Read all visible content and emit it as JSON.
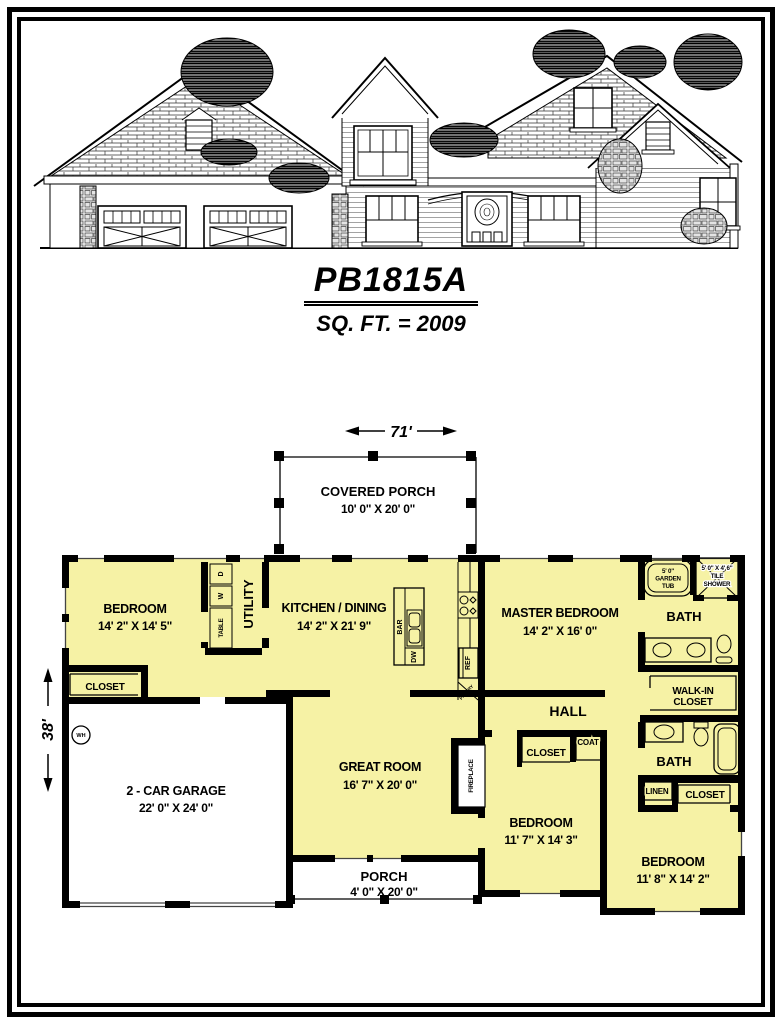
{
  "title": {
    "plan_number": "PB1815A",
    "sqft": "SQ. FT. = 2009"
  },
  "dimensions": {
    "overall_width": "71'",
    "overall_depth": "38'"
  },
  "colors": {
    "room_fill": "#F6F2A5",
    "wall": "#000000",
    "paper": "#FFFFFF"
  },
  "rooms": {
    "covered_porch": {
      "name": "COVERED PORCH",
      "dims": "10' 0\" X 20' 0\""
    },
    "bedroom1": {
      "name": "BEDROOM",
      "dims": "14' 2\" X 14' 5\""
    },
    "closet_bedroom1": {
      "name": "CLOSET"
    },
    "utility": {
      "name": "UTILITY"
    },
    "kitchen": {
      "name": "KITCHEN / DINING",
      "dims": "14' 2\" X 21' 9\""
    },
    "master_bedroom": {
      "name": "MASTER BEDROOM",
      "dims": "14' 2\" X 16' 0\""
    },
    "master_bath": {
      "name": "BATH"
    },
    "walk_in_closet": {
      "line1": "WALK-IN",
      "line2": "CLOSET"
    },
    "hall": {
      "name": "HALL"
    },
    "garage": {
      "name": "2 - CAR GARAGE",
      "dims": "22' 0\" X 24' 0\""
    },
    "great_room": {
      "name": "GREAT ROOM",
      "dims": "16' 7\" X 20' 0\""
    },
    "hall_closet": {
      "name": "CLOSET"
    },
    "coat_closet": {
      "name": "COAT"
    },
    "bath2": {
      "name": "BATH"
    },
    "linen": {
      "name": "LINEN"
    },
    "closet_bedroom3": {
      "name": "CLOSET"
    },
    "bedroom2": {
      "name": "BEDROOM",
      "dims": "11' 7\" X 14' 3\""
    },
    "bedroom3": {
      "name": "BEDROOM",
      "dims": "11' 8\" X 14' 2\""
    },
    "porch": {
      "name": "PORCH",
      "dims": "4' 0\" X 20' 0\""
    }
  },
  "fixtures": {
    "garden_tub": {
      "line1": "5' 0\"",
      "line2": "GARDEN",
      "line3": "TUB"
    },
    "tile_shower": {
      "line1": "5' 0\" X 4' 6\"",
      "line2": "TILE",
      "line3": "SHOWER"
    },
    "dryer": "D",
    "washer": "W",
    "table": "TABLE",
    "bar": "BAR",
    "dishwasher": "DW",
    "refrigerator": "REF",
    "pantry": "PANTRY",
    "fireplace": "FIREPLACE",
    "water_heater": "WH"
  }
}
